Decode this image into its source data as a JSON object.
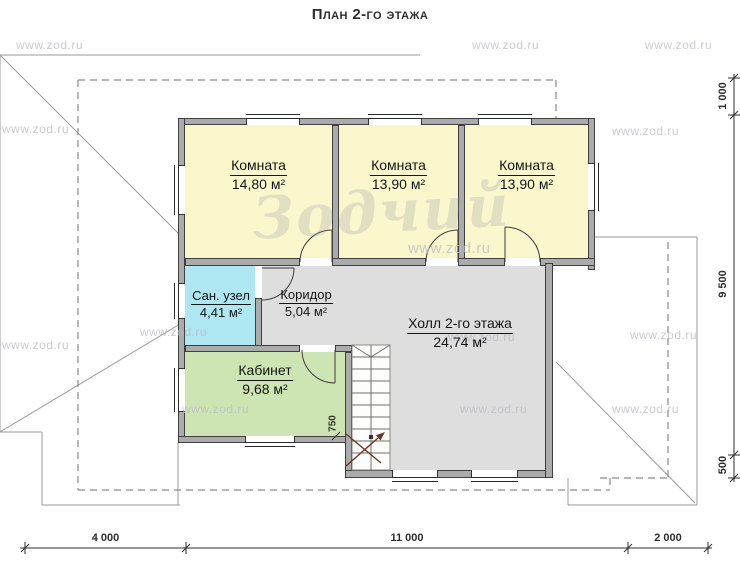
{
  "title": "План 2-го этажа",
  "watermark_text": "www.zod.ru",
  "logo_watermark": "Зодчий",
  "rooms": {
    "room1": {
      "name": "Комната",
      "area": "14,80 м²"
    },
    "room2": {
      "name": "Комната",
      "area": "13,90 м²"
    },
    "room3": {
      "name": "Комната",
      "area": "13,90 м²"
    },
    "bathroom": {
      "name": "Сан. узел",
      "area": "4,41 м²"
    },
    "corridor": {
      "name": "Коридор",
      "area": "5,04 м²"
    },
    "hall": {
      "name": "Холл 2-го этажа",
      "area": "24,74 м²"
    },
    "office": {
      "name": "Кабинет",
      "area": "9,68 м²"
    }
  },
  "dimensions": {
    "bottom": [
      "4 000",
      "11 000",
      "2 000"
    ],
    "right": [
      "1 000",
      "9 500",
      "500"
    ],
    "stair_width": "750"
  },
  "colors": {
    "room-yellow": "#FAF7CD",
    "room-cyan": "#AEE6F2",
    "room-green": "#CDE5B3",
    "room-gray": "#DEDEDE",
    "wall-fill": "#ABABAB",
    "wall-edge": "#3F3F3F",
    "roof-line": "#9A9A9A",
    "dash-line": "#8A8A8A",
    "dim-color": "#2E2E2E",
    "arrow-color": "#6E3328",
    "watermark-color": "#B9B9C2"
  }
}
